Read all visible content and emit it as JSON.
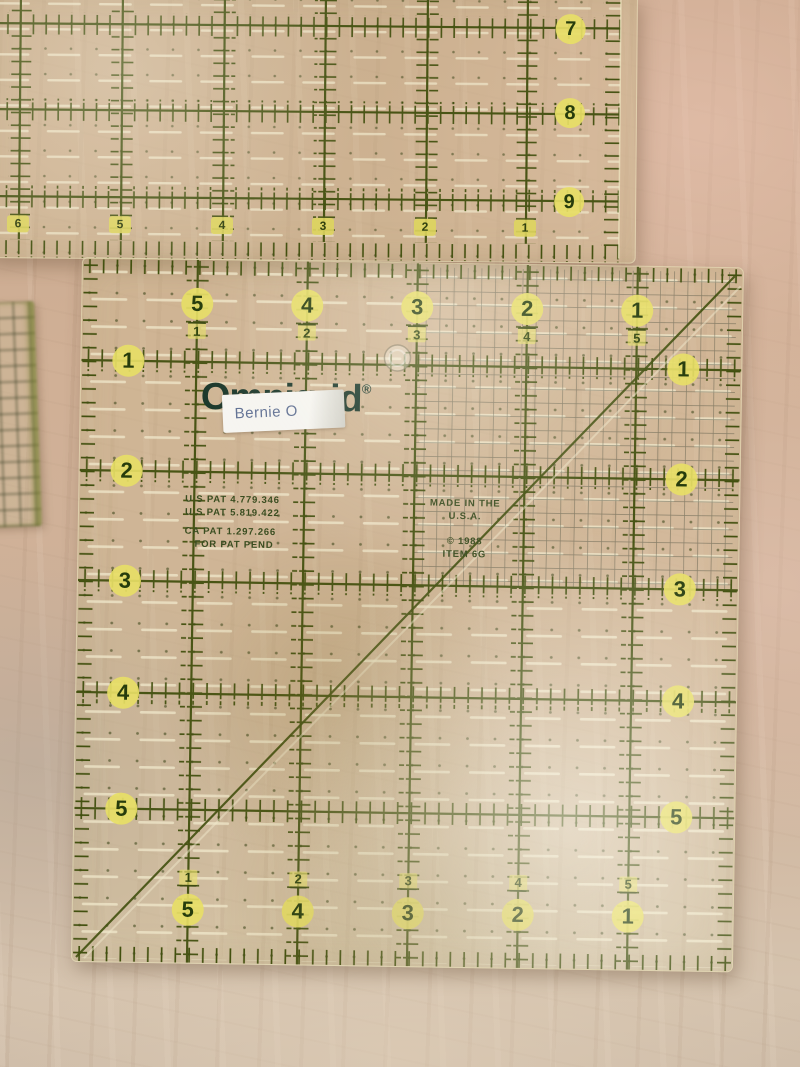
{
  "scene": {
    "setting": "wooden table",
    "subject": "transparent quilting rulers"
  },
  "top_ruler": {
    "right_labels": [
      "7",
      "8",
      "9"
    ],
    "bottom_labels": [
      "6",
      "5",
      "4",
      "3",
      "2",
      "1"
    ]
  },
  "main_ruler": {
    "brand": "Omnigrid",
    "registered_mark": "®",
    "sticker_text": "Bernie O",
    "top_edge": [
      {
        "large": "5",
        "small": "1"
      },
      {
        "large": "4",
        "small": "2"
      },
      {
        "large": "3",
        "small": "3"
      },
      {
        "large": "2",
        "small": "4"
      },
      {
        "large": "1",
        "small": "5"
      }
    ],
    "left_edge": [
      "1",
      "2",
      "3",
      "4",
      "5"
    ],
    "right_edge": [
      "1",
      "2",
      "3",
      "4",
      "5"
    ],
    "bottom_edge": [
      {
        "small": "1",
        "large": "5"
      },
      {
        "small": "2",
        "large": "4"
      },
      {
        "small": "3",
        "large": "3"
      },
      {
        "small": "4",
        "large": "2"
      },
      {
        "small": "5",
        "large": "1"
      }
    ],
    "patent_line1": "U.S PAT 4.779.346",
    "patent_line2": "U.S PAT 5.819.422",
    "patent_line3": "CA PAT 1.297.266",
    "patent_line4": "FOR PAT PEND",
    "made_in_line1": "MADE IN THE",
    "made_in_line2": "U.S.A.",
    "copyright": "© 1988",
    "item": "ITEM 6G"
  },
  "colors": {
    "grid_green": "#42500f",
    "label_yellow": "#e7de66",
    "engraved_cream": "#f0e8cb",
    "logo_green": "#1b382b",
    "sticker_text_blue": "#5f6f92",
    "wood_tan": "#cfae96"
  }
}
